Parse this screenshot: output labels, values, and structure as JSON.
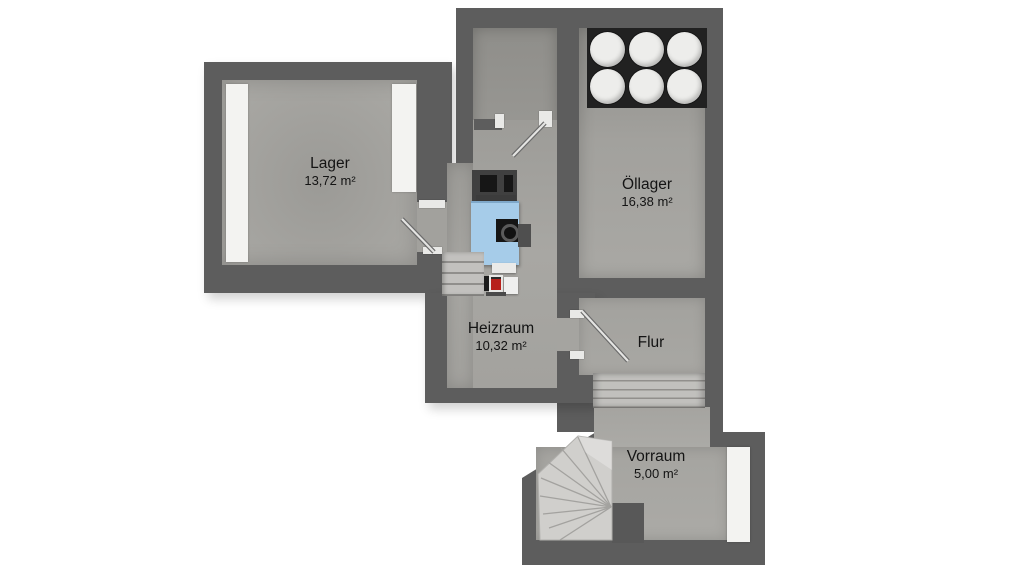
{
  "plan": {
    "rooms": {
      "lager": {
        "name": "Lager",
        "area": "13,72 m²"
      },
      "oellager": {
        "name": "Öllager",
        "area": "16,38 m²"
      },
      "heizraum": {
        "name": "Heizraum",
        "area": "10,32 m²"
      },
      "flur": {
        "name": "Flur"
      },
      "vorraum": {
        "name": "Vorraum",
        "area": "5,00 m²"
      }
    },
    "equipment": {
      "oil_tanks": {
        "icon": "oil-tank-circle",
        "count": 6
      },
      "boiler": {
        "icon": "boiler-blue-box"
      },
      "burner": {
        "icon": "burner-unit"
      },
      "chimney": {
        "icon": "chimney-block"
      },
      "straight_stairs": {
        "icon": "stair-treads"
      },
      "winder_stairs": {
        "icon": "winder-stair-fan"
      }
    },
    "colors": {
      "wall": "#5d5d5d",
      "floor": "#a7a6a2",
      "boiler_blue": "#a6cce9",
      "tank": "#ededeb",
      "tank_backdrop": "#212121",
      "stairs_light": "#d0cfcc",
      "white_fixture": "#f3f3f1",
      "text": "#141414",
      "background": "#ffffff"
    }
  }
}
